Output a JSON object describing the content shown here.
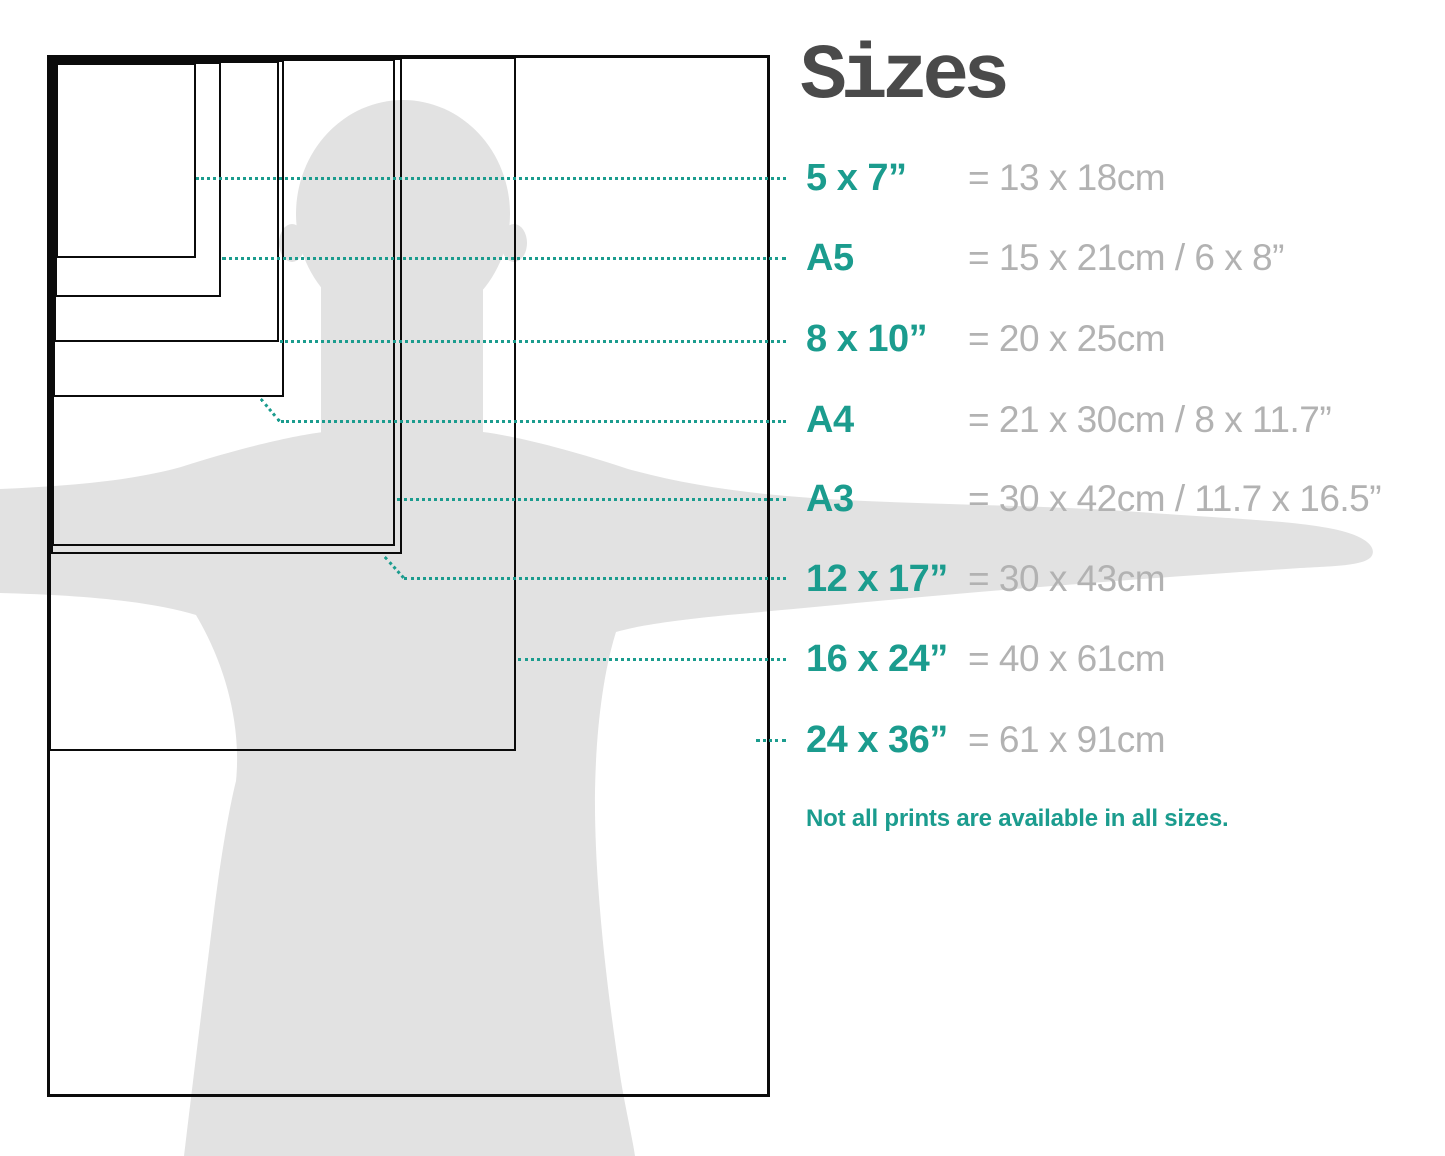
{
  "title": "Sizes",
  "note": "Not all prints are available in all sizes.",
  "sizes": [
    {
      "id": "5x7",
      "label": "5 x 7”",
      "value": "= 13 x 18cm"
    },
    {
      "id": "A5",
      "label": "A5",
      "value": "= 15 x 21cm / 6 x 8”"
    },
    {
      "id": "8x10",
      "label": "8 x 10”",
      "value": "= 20 x 25cm"
    },
    {
      "id": "A4",
      "label": "A4",
      "value": "= 21 x 30cm / 8 x 11.7”"
    },
    {
      "id": "A3",
      "label": "A3",
      "value": "= 30 x 42cm / 11.7 x 16.5”"
    },
    {
      "id": "12x17",
      "label": "12 x 17”",
      "value": "= 30 x 43cm"
    },
    {
      "id": "16x24",
      "label": "16 x 24”",
      "value": "= 40 x 61cm"
    },
    {
      "id": "24x36",
      "label": "24 x 36”",
      "value": "= 61 x 91cm"
    }
  ],
  "colors": {
    "accent": "#1B9C8E",
    "value_gray": "#B2B2B2",
    "title_gray": "#4A4A4A",
    "silhouette_gray": "#E2E2E2",
    "frame_black": "#0B0B0B"
  },
  "diagram": {
    "frames": [
      {
        "id": "24x36",
        "x": 47,
        "y": 55,
        "w": 723,
        "h": 1042,
        "b": 3
      },
      {
        "id": "16x24",
        "x": 49,
        "y": 57,
        "w": 467,
        "h": 694,
        "b": 2
      },
      {
        "id": "12x17",
        "x": 51,
        "y": 58,
        "w": 351,
        "h": 496,
        "b": 2
      },
      {
        "id": "A3",
        "x": 52,
        "y": 59,
        "w": 343,
        "h": 487,
        "b": 2
      },
      {
        "id": "A4",
        "x": 53,
        "y": 60,
        "w": 231,
        "h": 337,
        "b": 2
      },
      {
        "id": "8x10",
        "x": 54,
        "y": 61,
        "w": 225,
        "h": 281,
        "b": 2
      },
      {
        "id": "A5",
        "x": 55,
        "y": 62,
        "w": 166,
        "h": 235,
        "b": 2
      },
      {
        "id": "5x7",
        "x": 56,
        "y": 63,
        "w": 140,
        "h": 195,
        "b": 2
      }
    ],
    "pointers": [
      {
        "for": "5x7",
        "segments": [
          {
            "x": 196,
            "y": 177,
            "len": 590,
            "deg": 0
          }
        ]
      },
      {
        "for": "A5",
        "segments": [
          {
            "x": 222,
            "y": 257,
            "len": 564,
            "deg": 0
          }
        ]
      },
      {
        "for": "8x10",
        "segments": [
          {
            "x": 280,
            "y": 340,
            "len": 506,
            "deg": 0
          }
        ]
      },
      {
        "for": "A4",
        "segments": [
          {
            "x": 262,
            "y": 398,
            "len": 29,
            "deg": 50
          },
          {
            "x": 281,
            "y": 420,
            "len": 505,
            "deg": 0
          }
        ]
      },
      {
        "for": "A3",
        "segments": [
          {
            "x": 397,
            "y": 498,
            "len": 389,
            "deg": 0
          }
        ]
      },
      {
        "for": "12x17",
        "segments": [
          {
            "x": 386,
            "y": 556,
            "len": 28,
            "deg": 48
          },
          {
            "x": 404,
            "y": 577,
            "len": 382,
            "deg": 0
          }
        ]
      },
      {
        "for": "16x24",
        "segments": [
          {
            "x": 518,
            "y": 658,
            "len": 268,
            "deg": 0
          }
        ]
      },
      {
        "for": "24x36",
        "segments": [
          {
            "x": 756,
            "y": 739,
            "len": 30,
            "deg": 0
          }
        ]
      }
    ],
    "row_centers": [
      178,
      258,
      339,
      420,
      499,
      579,
      659,
      740
    ]
  }
}
